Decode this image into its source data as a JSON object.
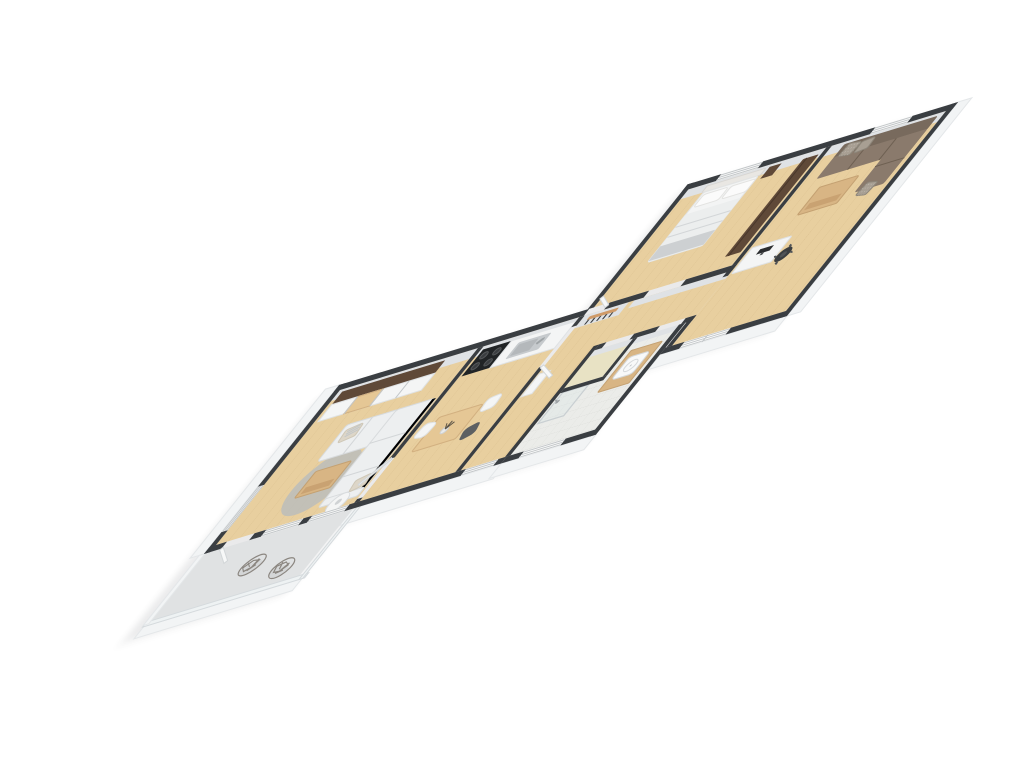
{
  "scene": {
    "type": "3d-floor-plan-render",
    "label": "Isometric 3D floor plan of an apartment with balcony",
    "rooms_total": 8
  },
  "palette": {
    "background": "#ffffff",
    "wall": "#3a3e42",
    "wallFaceInner": "#dfe2e5",
    "wallFaceOuter": "#f2f4f5",
    "floorWood": "#e8cf9f",
    "tile": "#ebece9",
    "tileLine": "#d6d8d4",
    "closetFloor": "#e8e2c4",
    "balconyFloor": "#e0e2e3",
    "glassRailing": "#eef2f3",
    "glassLine": "#c9cfd2",
    "sofaLight": "#edeff0",
    "sofaBrown": "#8a7a6c",
    "sofaBrownDark": "#786a5d",
    "pillowBeige": "#ddd6c8",
    "pillowBrown": "#a89f93",
    "woodFurniture": "#d8b584",
    "woodLight": "#e5c795",
    "woodDark": "#5f4938",
    "rug": "#b8bbbd",
    "whiteFurn": "#f4f5f5",
    "steel": "#c6cacd",
    "stove": "#212426",
    "burner": "#3a3d40",
    "chairMesh": "#8b8680",
    "coatRack": "#cf9a67",
    "hook": "#3a3d3f",
    "officeChair": "#3b3e40",
    "monitor": "#2b2d2f",
    "windowFrame": "#c3c7c9",
    "doorLeaf": "#f7f8f8",
    "shadow": "#3c4146"
  },
  "rooms": [
    {
      "name": "Living room",
      "floor": "light oak",
      "furniture": [
        "sliding-door wardrobe",
        "white sectional sofa",
        "striped pillow",
        "wood coffee table",
        "round grey rug",
        "round side table"
      ]
    },
    {
      "name": "Kitchen and dining",
      "floor": "light oak",
      "furniture": [
        "black stove with 4 burners",
        "white counter with steel sink",
        "dining table",
        "two white chairs",
        "dark chair",
        "vase with branches"
      ]
    },
    {
      "name": "Hallway",
      "floor": "light oak",
      "furniture": [
        "wall coat rack with 5 hooks",
        "white cabinet"
      ]
    },
    {
      "name": "Closet",
      "floor": "beige",
      "furniture": []
    },
    {
      "name": "Bathroom",
      "floor": "white tile",
      "furniture": [
        "walk-in shower",
        "wood vanity with square basin"
      ]
    },
    {
      "name": "Bedroom",
      "floor": "light oak",
      "furniture": [
        "double bed with white bedding",
        "padded headboard",
        "dark wood nightstand",
        "dark brown dresser"
      ]
    },
    {
      "name": "Office lounge",
      "floor": "light oak",
      "furniture": [
        "brown sectional sofa",
        "patterned pillows",
        "wood coffee table",
        "white desk",
        "monitor",
        "dark office chair"
      ]
    },
    {
      "name": "Balcony",
      "floor": "concrete grey",
      "furniture": [
        "wire mesh chair",
        "wire mesh chair",
        "glass railing"
      ]
    }
  ],
  "openings": {
    "windows": [
      "living-room-window-1",
      "living-room-window-2",
      "hall-window",
      "bathroom-window",
      "bedroom-window",
      "office-top-window",
      "office-side-window",
      "end-wall-window"
    ],
    "doors": [
      "balcony-door",
      "entry-door",
      "kitchen-door",
      "living-kitchen-door",
      "bedroom-door",
      "office-door"
    ]
  },
  "details": {
    "balcony_chairs": 2,
    "coat_hooks": 5,
    "stove_burners": 4,
    "bed_pillows": 2
  }
}
